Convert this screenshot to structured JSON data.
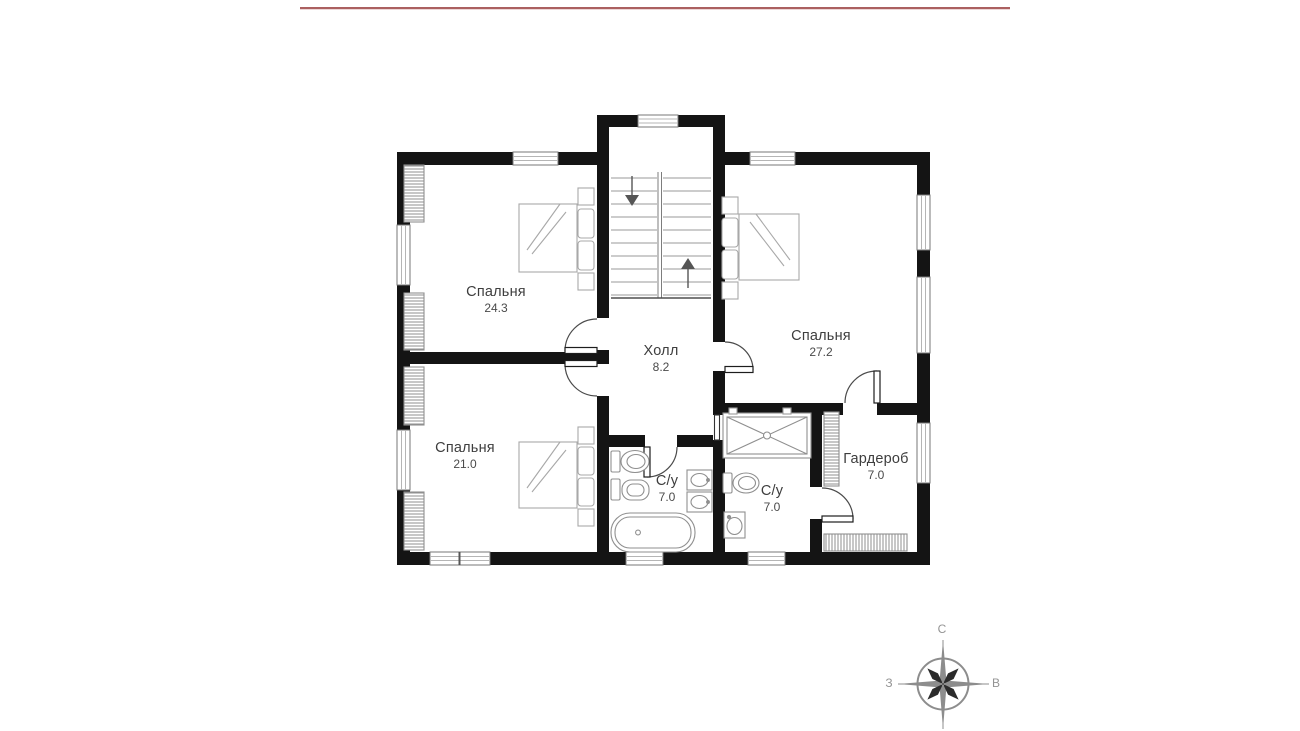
{
  "header": {
    "rule_color": "#ab6060"
  },
  "floor_plan": {
    "rooms": [
      {
        "id": "bedroom-top-left",
        "name": "Спальня",
        "area": "24.3"
      },
      {
        "id": "bedroom-right",
        "name": "Спальня",
        "area": "27.2"
      },
      {
        "id": "bedroom-bottom-left",
        "name": "Спальня",
        "area": "21.0"
      },
      {
        "id": "hall",
        "name": "Холл",
        "area": "8.2"
      },
      {
        "id": "bathroom-left",
        "name": "С/у",
        "area": "7.0"
      },
      {
        "id": "bathroom-right",
        "name": "С/у",
        "area": "7.0"
      },
      {
        "id": "wardrobe",
        "name": "Гардероб",
        "area": "7.0"
      }
    ],
    "compass": {
      "north": "С",
      "west": "З",
      "east": "В"
    },
    "colors": {
      "wall": "#141414",
      "furniture_stroke": "#a8a8a8",
      "fixture_stroke": "#8f8f8f",
      "door": "#444444",
      "label_text": "#3e3e3e",
      "compass_gray": "#8d8d8d"
    }
  }
}
